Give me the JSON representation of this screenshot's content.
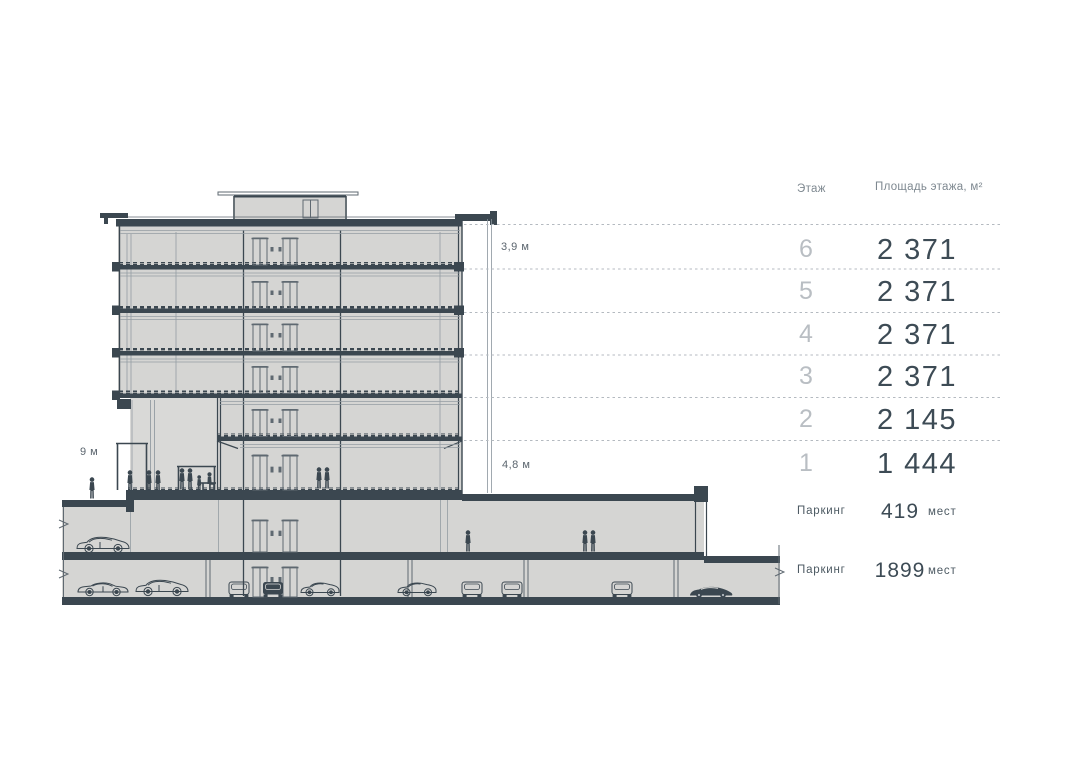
{
  "table": {
    "header": {
      "floor": "Этаж",
      "area": "Площадь этажа, м²"
    },
    "rows": [
      {
        "floor": "6",
        "area": "2 371"
      },
      {
        "floor": "5",
        "area": "2 371"
      },
      {
        "floor": "4",
        "area": "2 371"
      },
      {
        "floor": "3",
        "area": "2 371"
      },
      {
        "floor": "2",
        "area": "2 145"
      },
      {
        "floor": "1",
        "area": "1 444"
      }
    ],
    "parking": [
      {
        "label": "Паркинг",
        "value": "419",
        "unit": "мест"
      },
      {
        "label": "Паркинг",
        "value": "1899",
        "unit": "мест"
      }
    ]
  },
  "dimensions": {
    "floor_height": "3,9 м",
    "first_floor_height": "4,8 м",
    "left_overhang_height": "9 м"
  },
  "icons": [
    "person-icon",
    "person-sitting-icon",
    "bench-icon",
    "car-sedan-icon",
    "car-suv-icon",
    "car-hatchback-icon",
    "car-rear-icon",
    "car-sports-icon",
    "elevator-door-icon"
  ],
  "colors": {
    "ink": "#3b4750",
    "line": "#5f6971",
    "light_line": "#949ca3",
    "building_fill": "#d5d5d3",
    "dash": "#b4bac0",
    "value_text": "#3d4b55",
    "floor_number_text": "#b9bec3",
    "header_text": "#7e8890",
    "dimension_text": "#5b656e"
  }
}
